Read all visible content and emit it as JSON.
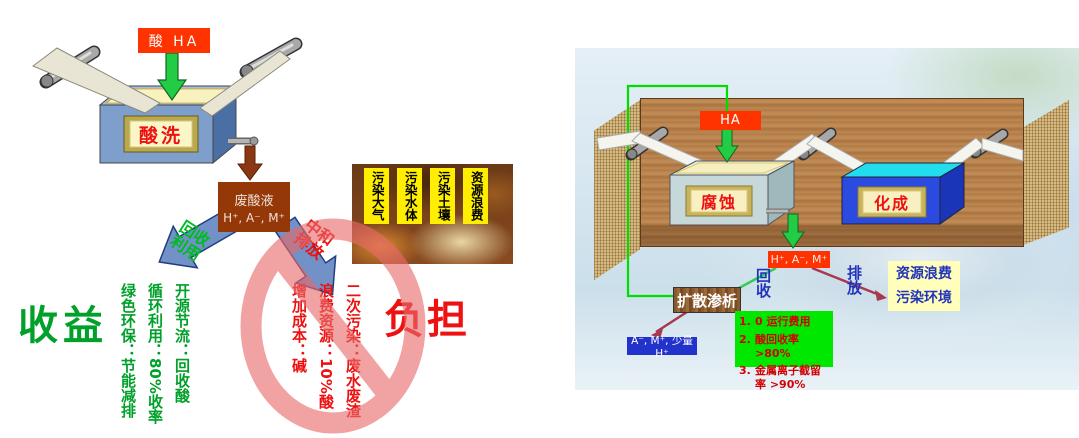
{
  "left": {
    "acid_label": "酸 HA",
    "tank_label": "酸洗",
    "waste_line1": "废酸液",
    "waste_line2": "H⁺, A⁻, M⁺",
    "recycle_arrow": "回收利用",
    "neutral_arrow": "中和排放",
    "photo_strips": [
      "污染大气",
      "污染水体",
      "污染土壤",
      "资源浪费"
    ],
    "benefit_title": "收益",
    "benefit_items": [
      "开源节流：回收酸",
      "循环利用：80%收率",
      "绿色环保：节能减排"
    ],
    "burden_title": "负担",
    "burden_items": [
      "增加成本：碱",
      "浪费资源：10%酸",
      "二次污染：废水废渣"
    ]
  },
  "right": {
    "acid_label": "HA",
    "corrosion_tank_label": "腐蚀",
    "formation_tank_label": "化成",
    "waste_label": "H⁺, A⁻, M⁺",
    "recycle_label": "回收",
    "discharge_label": "排放",
    "warning_line1": "资源浪费",
    "warning_line2": "污染环境",
    "dialysis_label": "扩散渗析",
    "recovered_label": "A⁻, M⁺, 少量H⁺",
    "benefits": [
      {
        "num": "1.",
        "text": "0 运行费用"
      },
      {
        "num": "2.",
        "text": "酸回收率 >80%"
      },
      {
        "num": "3.",
        "text": "金属离子截留率 >90%"
      }
    ]
  },
  "colors": {
    "acid_red": "#FF3300",
    "arrow_green": "#22CC44",
    "waste_brown": "#953808",
    "benefit_green": "#00A02A",
    "burden_red": "#EE1111",
    "prohibition_pink": "#E96A6A",
    "benefit_box_green": "#00E800",
    "warning_yellow": "#FFFFBB",
    "label_blue": "#2233BB"
  }
}
